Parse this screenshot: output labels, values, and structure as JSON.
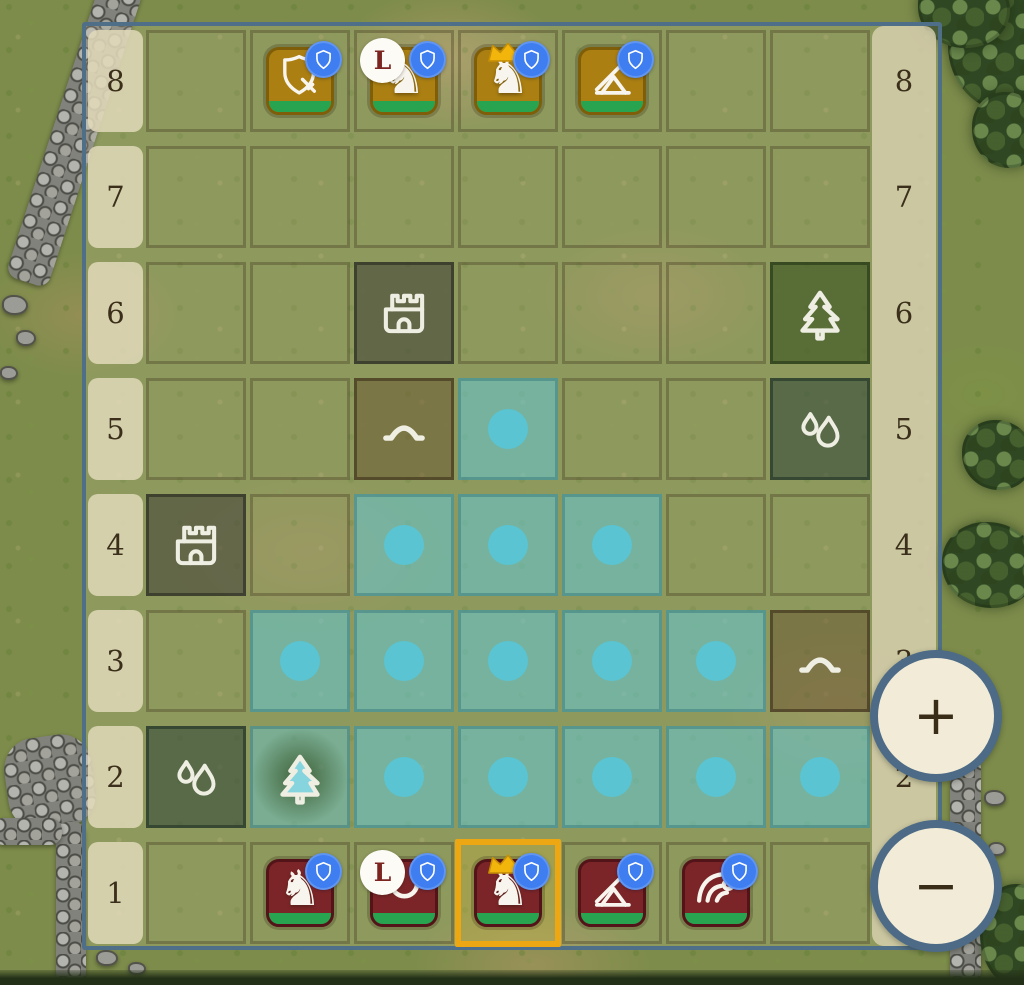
{
  "controls": {
    "zoom_in": "+",
    "zoom_out": "−"
  },
  "board": {
    "row_labels": [
      "8",
      "7",
      "6",
      "5",
      "4",
      "3",
      "2",
      "1"
    ],
    "columns": 7,
    "terrain": [
      {
        "row": "6",
        "col": 3,
        "type": "castle"
      },
      {
        "row": "6",
        "col": 7,
        "type": "forest"
      },
      {
        "row": "5",
        "col": 3,
        "type": "hill"
      },
      {
        "row": "5",
        "col": 7,
        "type": "water"
      },
      {
        "row": "4",
        "col": 1,
        "type": "castle"
      },
      {
        "row": "3",
        "col": 7,
        "type": "hill"
      },
      {
        "row": "2",
        "col": 1,
        "type": "water"
      },
      {
        "row": "2",
        "col": 2,
        "type": "forest",
        "highlighted": true
      }
    ],
    "move_targets": [
      {
        "row": "5",
        "col": 4
      },
      {
        "row": "4",
        "col": 3
      },
      {
        "row": "4",
        "col": 4
      },
      {
        "row": "4",
        "col": 5
      },
      {
        "row": "3",
        "col": 2
      },
      {
        "row": "3",
        "col": 3
      },
      {
        "row": "3",
        "col": 4
      },
      {
        "row": "3",
        "col": 5
      },
      {
        "row": "3",
        "col": 6
      },
      {
        "row": "2",
        "col": 3
      },
      {
        "row": "2",
        "col": 4
      },
      {
        "row": "2",
        "col": 5
      },
      {
        "row": "2",
        "col": 6
      },
      {
        "row": "2",
        "col": 7
      }
    ],
    "selected": {
      "row": "1",
      "col": 4
    }
  },
  "pieces": [
    {
      "row": "8",
      "col": 2,
      "side": "gold",
      "unit": "shield-guard",
      "icon": "shield-sword",
      "shield_badge": true
    },
    {
      "row": "8",
      "col": 3,
      "side": "gold",
      "unit": "knight",
      "icon": "knight",
      "shield_badge": true,
      "level_badge": "L"
    },
    {
      "row": "8",
      "col": 4,
      "side": "gold",
      "unit": "king",
      "icon": "knight",
      "crown": true,
      "shield_badge": true
    },
    {
      "row": "8",
      "col": 5,
      "side": "gold",
      "unit": "catapult",
      "icon": "catapult",
      "shield_badge": true
    },
    {
      "row": "1",
      "col": 2,
      "side": "red",
      "unit": "knight",
      "icon": "knight",
      "shield_badge": true
    },
    {
      "row": "1",
      "col": 3,
      "side": "red",
      "unit": "lancer",
      "icon": "ring",
      "shield_badge": true,
      "level_badge": "L"
    },
    {
      "row": "1",
      "col": 4,
      "side": "red",
      "unit": "king",
      "icon": "knight",
      "crown": true,
      "shield_badge": true,
      "selected": true
    },
    {
      "row": "1",
      "col": 5,
      "side": "red",
      "unit": "catapult",
      "icon": "catapult",
      "shield_badge": true
    },
    {
      "row": "1",
      "col": 6,
      "side": "red",
      "unit": "wave-mage",
      "icon": "wave",
      "shield_badge": true
    }
  ],
  "glyphs": {
    "knight": "♞"
  },
  "colors": {
    "gold_piece": "#ab7f12",
    "red_piece": "#7c2528",
    "health_bar": "#28a350",
    "badge_blue": "#3f7ef0",
    "move_highlight": "#64c6d2",
    "move_dot": "#58c5d7",
    "selection": "#eda712",
    "frame": "#4f6e87",
    "label_bg": "#e2d9ba",
    "label_text": "#3b2f1b",
    "crown_gold": "#f2b50c"
  }
}
